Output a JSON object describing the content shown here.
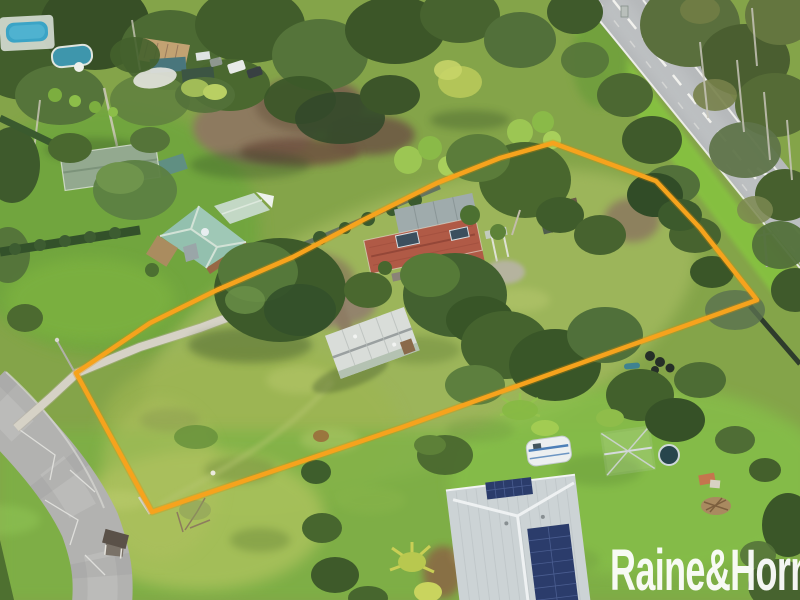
{
  "photo": {
    "kind": "aerial drone photograph",
    "subject": "semi-rural acreage for sale, lot outlined in orange beside a highway"
  },
  "watermark": {
    "text": "Raine&Horne",
    "color": "#ffffff"
  },
  "boundary": {
    "points": "553,143 656,181 700,228 757,300 400,428 152,512 76,373 150,323 217,290 293,257 363,220 437,183 500,158",
    "color": "#f6a31d"
  },
  "palette": {
    "grass_base": "#84a449",
    "paddock_grass": "#a3ba5e",
    "lawn_green": "#6fa63e",
    "forest_dark": "#3a5628",
    "highway_asphalt": "#b6b9bb",
    "street_asphalt": "#b2b2b0",
    "driveway_concrete": "#d6d2c6",
    "dirt_brown": "#8d7a5f",
    "roof_teal": "#93c0ae",
    "roof_red": "#b05a46",
    "roof_shed": "#d9ddd9",
    "roof_solar_house": "#ccd3d5",
    "solar_panel": "#2b3c6b",
    "caravan_white": "#eceff0",
    "pool_blue": "#3ba4c6",
    "road_marking": "#f2f2ee"
  }
}
